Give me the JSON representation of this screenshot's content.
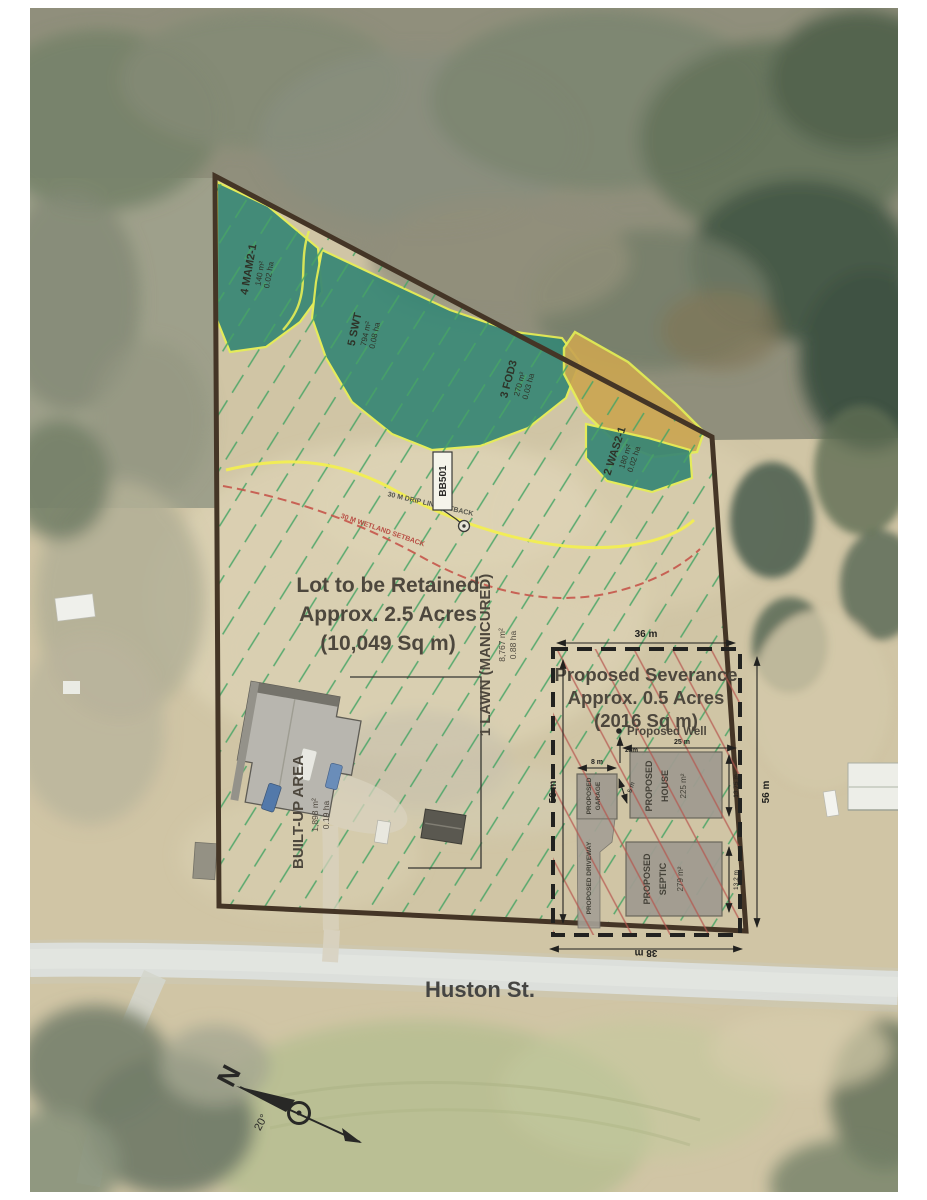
{
  "map": {
    "road_name": "Huston St.",
    "retained_lot": {
      "line1": "Lot to be Retained",
      "line2": "Approx. 2.5 Acres",
      "line3": "(10,049 Sq m)"
    },
    "severance": {
      "line1": "Proposed Severance",
      "line2": "Approx. 0.5 Acres",
      "line3": "(2016 Sq m)",
      "well_label": "Proposed Well",
      "house": {
        "line1": "PROPOSED",
        "line2": "HOUSE",
        "area": "225 m²"
      },
      "garage": {
        "line1": "PROPOSED",
        "line2": "GARAGE"
      },
      "driveway": {
        "label": "PROPOSED DRIVEWAY"
      },
      "septic": {
        "line1": "PROPOSED",
        "line2": "SEPTIC",
        "area": "279 m²"
      },
      "dimensions": {
        "top": "36 m",
        "bottom": "38 m",
        "left": "56 m",
        "right": "56 m",
        "house_side": "13.75 m",
        "septic_side": "13.2 m",
        "garage_width": "8 m",
        "house_gap": "5 m",
        "well_north": "23m",
        "well_east": "25 m"
      }
    },
    "zones": {
      "lawn": {
        "label": "1 LAWN (MANICURED)",
        "area": "8,767 m²",
        "hectares": "0.88 ha"
      },
      "built_up": {
        "label": "BUILT-UP AREA",
        "area": "1,898 m²",
        "hectares": "0.19 ha"
      },
      "mam2": {
        "label": "4 MAM2-1",
        "area": "140 m²",
        "hectares": "0.02 ha"
      },
      "swt": {
        "label": "5 SWT",
        "area": "794 m²",
        "hectares": "0.08 ha"
      },
      "fod3": {
        "label": "3 FOD3",
        "area": "270 m²",
        "hectares": "0.03 ha"
      },
      "was2": {
        "label": "2 WAS2-1",
        "area": "180 m²",
        "hectares": "0.02 ha"
      }
    },
    "setbacks": {
      "drip_line": "30 M DRIP LINE SETBACK",
      "wetland": "30 M WETLAND SETBACK"
    },
    "survey_marker": {
      "label": "BB501"
    },
    "compass": {
      "north": "N",
      "declination": "20°"
    },
    "colors": {
      "boundary": "#3a2a1c",
      "lawn_hatch": "#3da05f",
      "severance_hatch": "#b24b46",
      "wetland_teal": "#2c7f70",
      "wetland_tan": "#c8a14b",
      "wetland_outline": "#e5ee4e",
      "drip_line": "#f2ee4b",
      "setback_red": "#c34b42"
    }
  }
}
